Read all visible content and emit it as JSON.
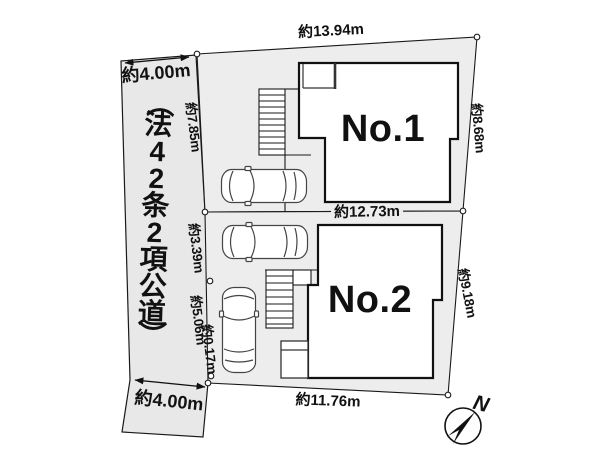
{
  "road": {
    "name": "（法42条2項公道）",
    "width_top": "約4.00m",
    "width_bottom": "約4.00m"
  },
  "lots": [
    {
      "name": "No.1",
      "dims": {
        "top": "約13.94m",
        "left": "約7.85m",
        "right": "約8.68m"
      }
    },
    {
      "name": "No.2",
      "dims": {
        "top": "約12.73m",
        "left_upper": "約3.39m",
        "left_lower": "約5.06m",
        "left_bottom": "約0.17m",
        "right": "約9.18m",
        "bottom": "約11.76m"
      }
    }
  ],
  "compass": {
    "label": "N"
  },
  "colors": {
    "lot_fill": "#ededed",
    "road_fill": "#e8e8e8",
    "building_fill": "#ffffff",
    "line": "#1a1a1a"
  }
}
